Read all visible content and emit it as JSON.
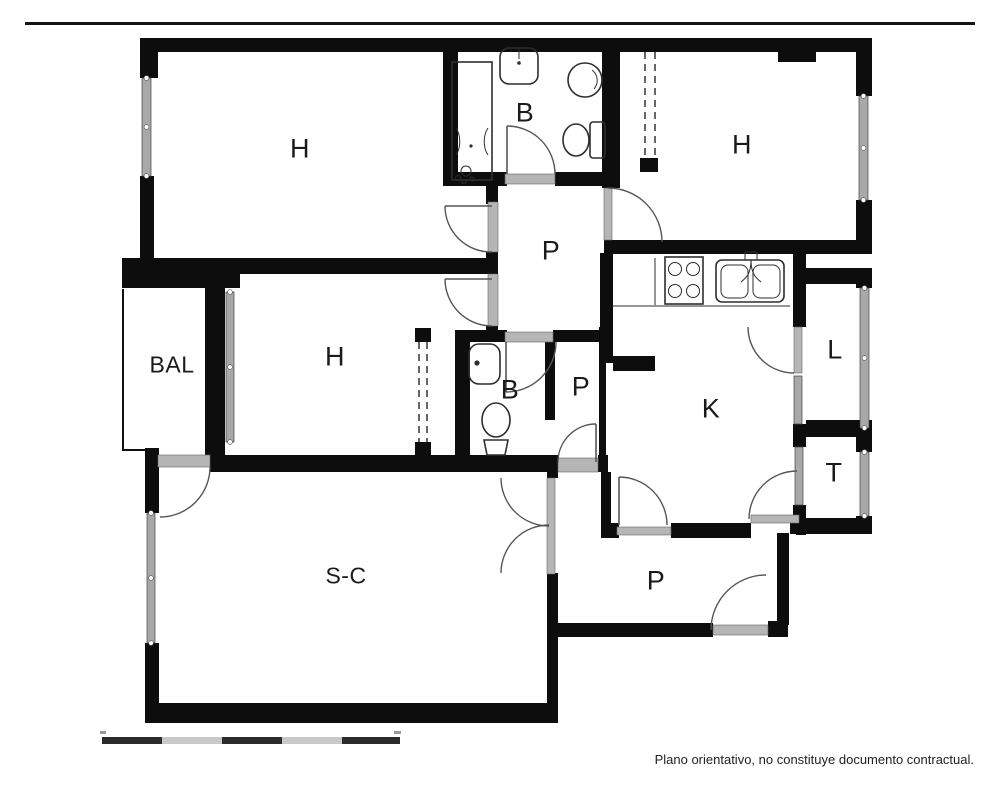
{
  "rooms": [
    {
      "id": "bedroom-top-left",
      "label": "H"
    },
    {
      "id": "bathroom-top",
      "label": "B"
    },
    {
      "id": "bedroom-top-right",
      "label": "H"
    },
    {
      "id": "passage-main",
      "label": "P"
    },
    {
      "id": "balcony",
      "label": "BAL"
    },
    {
      "id": "bedroom-mid-left",
      "label": "H"
    },
    {
      "id": "bathroom-mid",
      "label": "B"
    },
    {
      "id": "passage-small",
      "label": "P"
    },
    {
      "id": "kitchen",
      "label": "K"
    },
    {
      "id": "gallery",
      "label": "L"
    },
    {
      "id": "toilet-room",
      "label": "T"
    },
    {
      "id": "living-dining",
      "label": "S-C"
    },
    {
      "id": "passage-entry",
      "label": "P"
    }
  ],
  "footer": {
    "disclaimer": "Plano orientativo, no constituye documento contractual."
  },
  "icons": {
    "fixtures": [
      "shower-icon",
      "sink-icon",
      "washbasin-icon",
      "toilet-icon",
      "stove-icon",
      "kitchen-sink-icon"
    ]
  },
  "scale_bar": {
    "segments": 5
  },
  "colors": {
    "wall": "#0d0d0d",
    "window": "#a8a8a8",
    "door_arc": "#555555",
    "text": "#1a1a1a",
    "background": "#ffffff"
  }
}
